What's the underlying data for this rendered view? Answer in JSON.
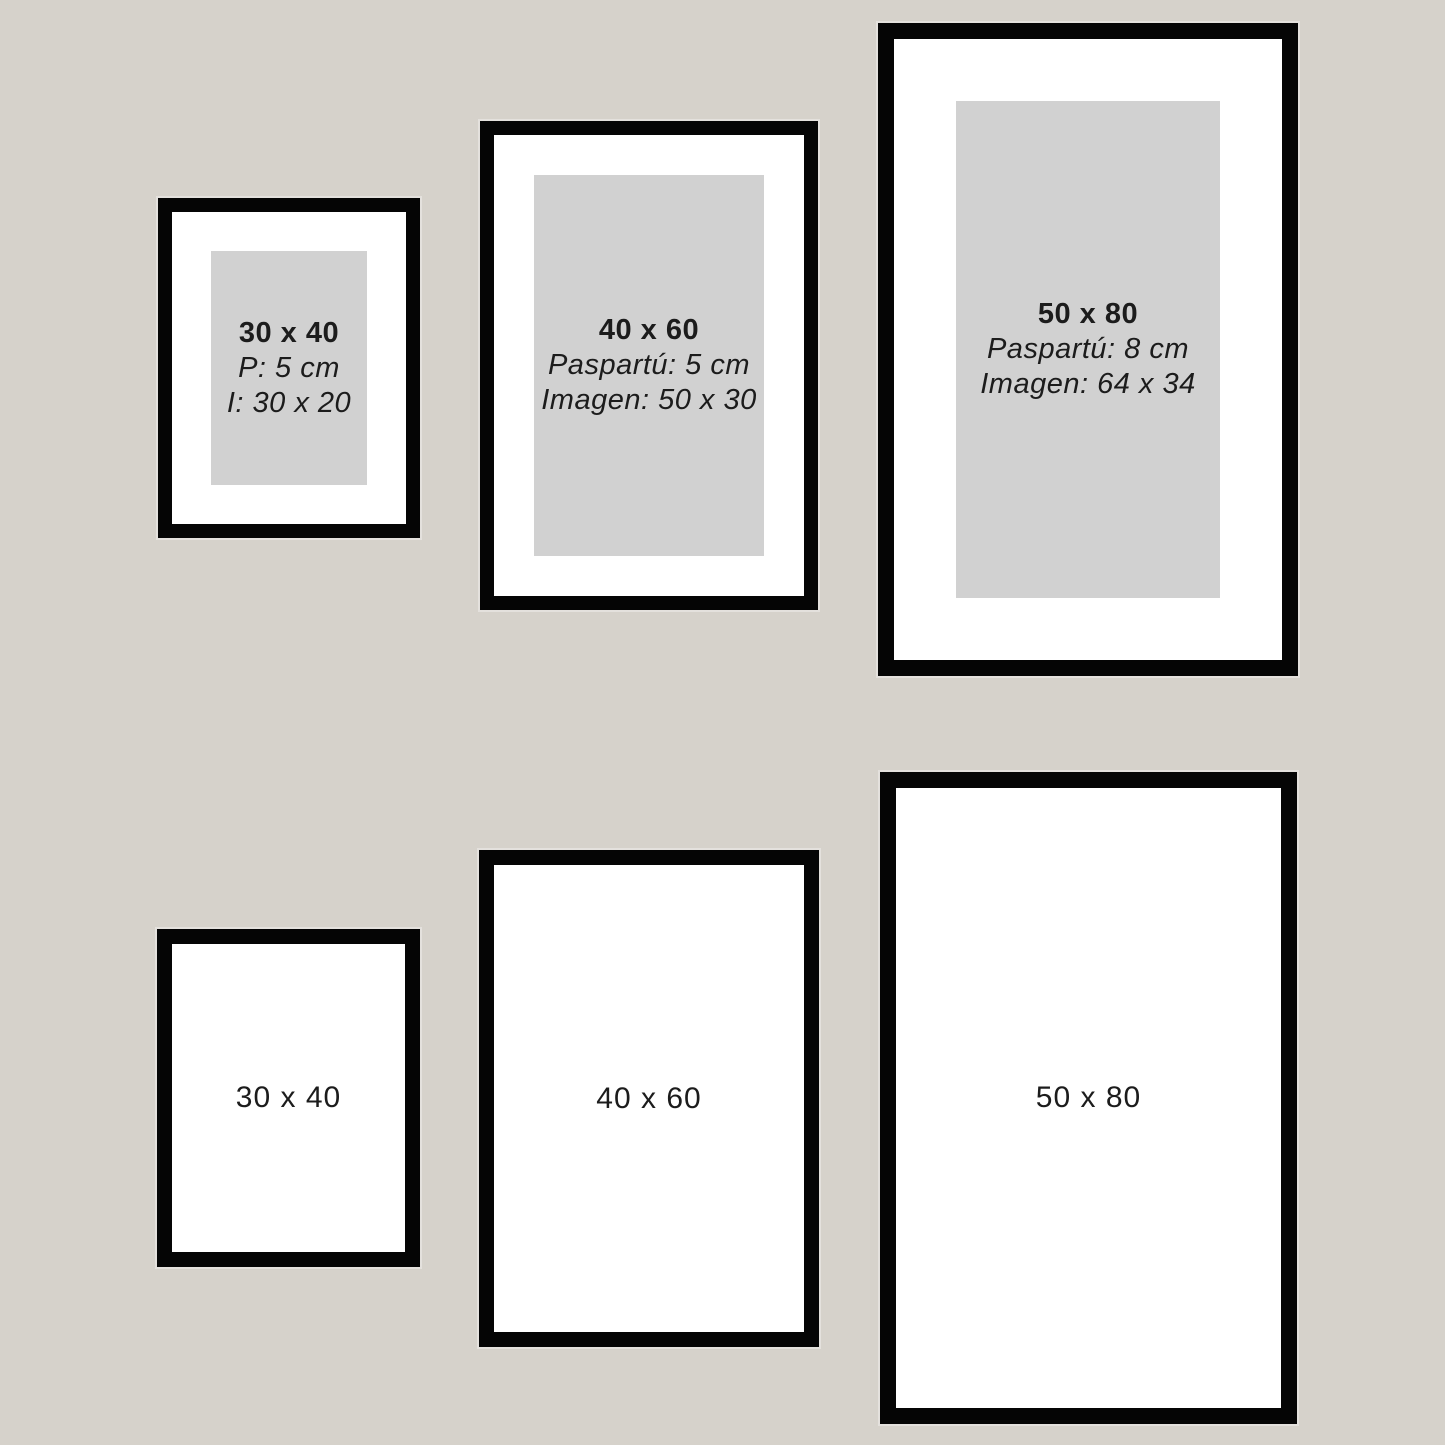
{
  "colors": {
    "background": "#d6d2cb",
    "frame": "#050505",
    "mat": "#ffffff",
    "image_placeholder": "#d1d1d1",
    "text": "#1c1c1c"
  },
  "matted_frames": [
    {
      "size": "30 x 40",
      "mat_info": "P: 5 cm",
      "image_info": "I: 30 x 20"
    },
    {
      "size": "40 x 60",
      "mat_info": "Paspartú: 5 cm",
      "image_info": "Imagen: 50 x 30"
    },
    {
      "size": "50 x 80",
      "mat_info": "Paspartú: 8 cm",
      "image_info": "Imagen: 64 x 34"
    }
  ],
  "plain_frames": [
    {
      "size": "30 x 40"
    },
    {
      "size": "40 x 60"
    },
    {
      "size": "50 x 80"
    }
  ]
}
